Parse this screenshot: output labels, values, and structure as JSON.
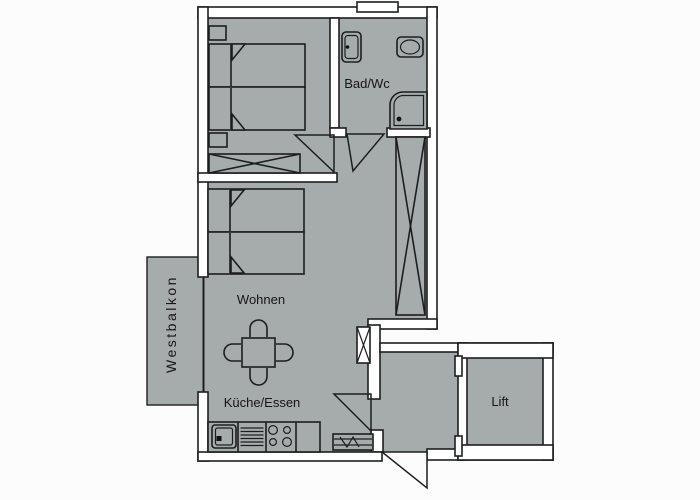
{
  "floorplan": {
    "type": "apartment-floor-plan",
    "rooms": {
      "bad_wc": {
        "label": "Bad/Wc"
      },
      "wohnen": {
        "label": "Wohnen"
      },
      "kueche_essen": {
        "label": "Küche/Essen"
      },
      "westbalkon": {
        "label": "Westbalkon"
      },
      "lift": {
        "label": "Lift"
      }
    },
    "colors": {
      "floor": "#a6abab",
      "walls": "#ffffff",
      "lines": "#1d1f1f",
      "background": "#fcfcfc",
      "label_text": "#161616"
    },
    "fixtures": [
      "double-bed",
      "double-bed",
      "nightstand",
      "nightstand",
      "wardrobe-crossed",
      "tall-cabinet-crossed",
      "washbasin",
      "toilet",
      "corner-shower",
      "window",
      "dining-table",
      "chair",
      "chair",
      "chair",
      "chair",
      "kitchen-sink",
      "dishwasher",
      "stove",
      "kitchen-counter",
      "radiator",
      "entrance-door",
      "room-door",
      "bath-door",
      "balcony-window",
      "lift-door"
    ]
  }
}
